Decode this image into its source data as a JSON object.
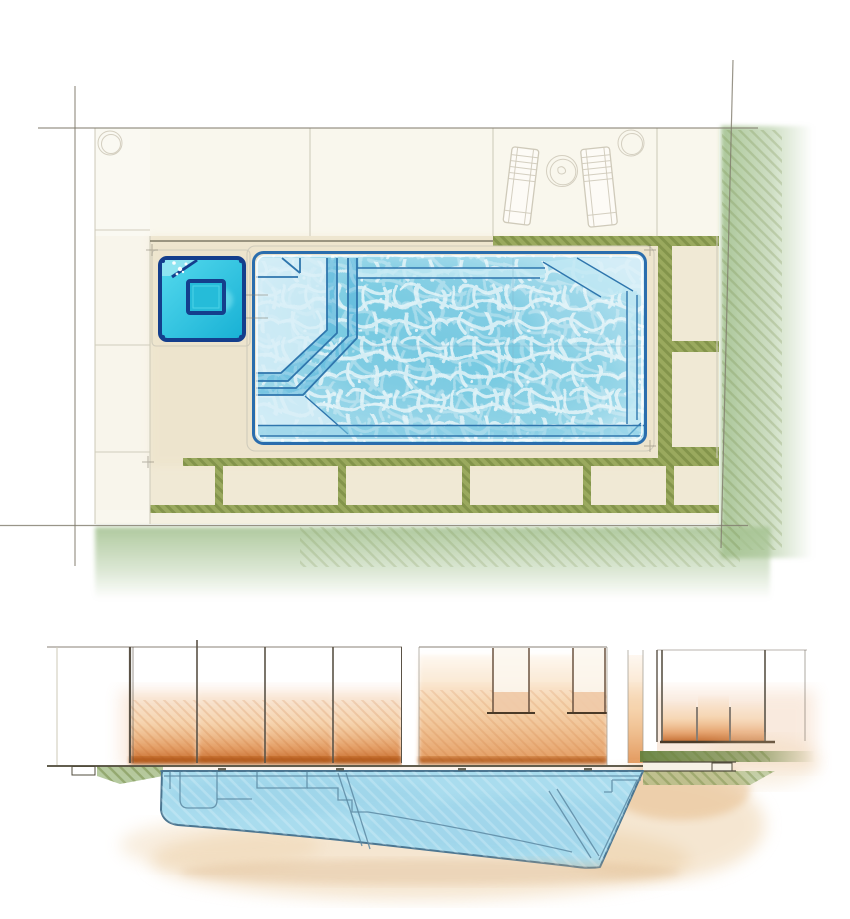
{
  "canvas": {
    "width": 850,
    "height": 919
  },
  "scene": {
    "type": "watercolor-pool-design-sketch",
    "views": [
      "plan-view",
      "section-view"
    ]
  },
  "colors": {
    "paper": "#ffffff",
    "deck_cream": "#f0e9d5",
    "deck_white": "#fbfaf3",
    "deck_warm": "#ebdfc2",
    "pencil": "#7f7a6c",
    "pencil_light": "#cfcaba",
    "grass_joint": "#9aa95e",
    "grass_hatch": "#6b8038",
    "lawn": "#a7c494",
    "pool_outline": "#2a6dad",
    "water_deep": "#7ecbe2",
    "water_mid": "#9bd7e9",
    "water_pale": "#c2e7f3",
    "water_light": "#d8eff8",
    "water_web": "#eef8fb",
    "step_edge": "#2f76ad",
    "step_riser": "#58b4da",
    "spa_fill_a": "#55daee",
    "spa_fill_b": "#17b0d4",
    "spa_dark": "#143e8c",
    "spa_glow": "#8feaf4",
    "section_shell": "#a9dcee",
    "section_line": "#4b7590",
    "section_line_soft": "#5d89a3",
    "fence_line": "#5a5246",
    "amber_hi": "#f3c083",
    "amber": "#e09050",
    "amber_deep": "#bf5f1d",
    "earth": "#eccfa5",
    "ground": "#514c3c",
    "grass_band": "#64803c",
    "grass_soft": "#8fae6b"
  },
  "plan": {
    "furniture": {
      "lounge_chairs": 2,
      "side_tables": 1,
      "deck_circles": 2
    },
    "pool": {
      "step_bands": 3,
      "corner_benches": 1,
      "tanning_ledges": 2
    },
    "spa": {
      "inner_benches": 1
    },
    "deck": {
      "bottom_paver_count": 5,
      "right_tile_count": 2
    }
  },
  "section": {
    "fence_posts": 5,
    "wall_openings": 2,
    "coping_ticks": 4,
    "lawn_steps": 1
  }
}
